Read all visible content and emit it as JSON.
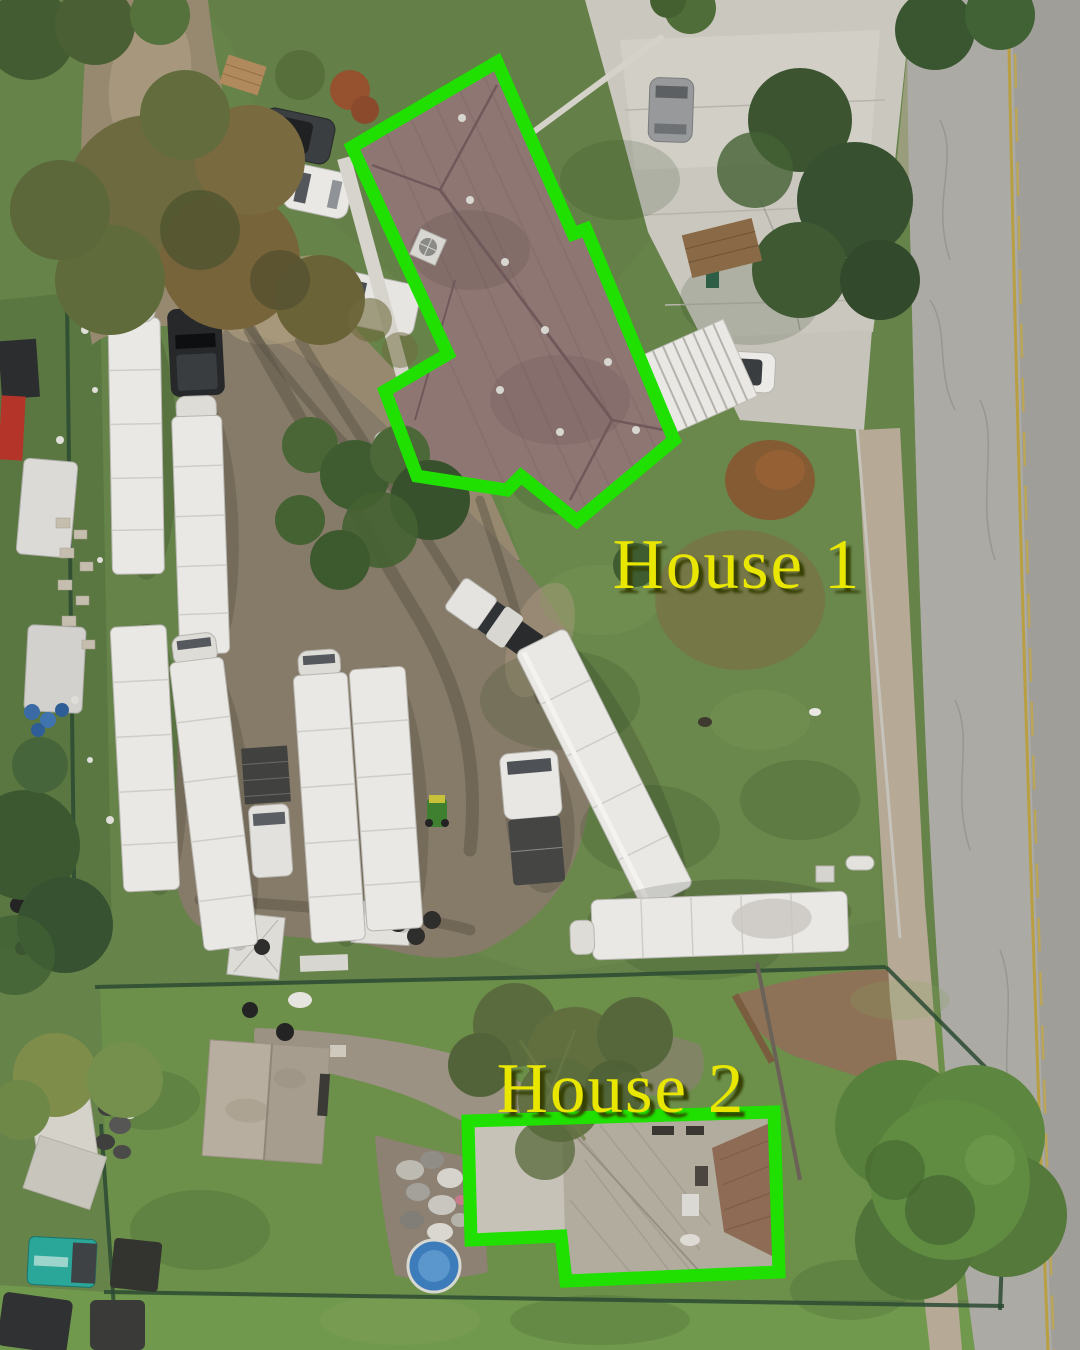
{
  "annotations": {
    "house1": {
      "label": "House 1"
    },
    "house2": {
      "label": "House 2"
    }
  },
  "colors": {
    "outline_green": "#1fe000",
    "label_yellow": "#e9e600",
    "label_shadow": "#333c06"
  }
}
